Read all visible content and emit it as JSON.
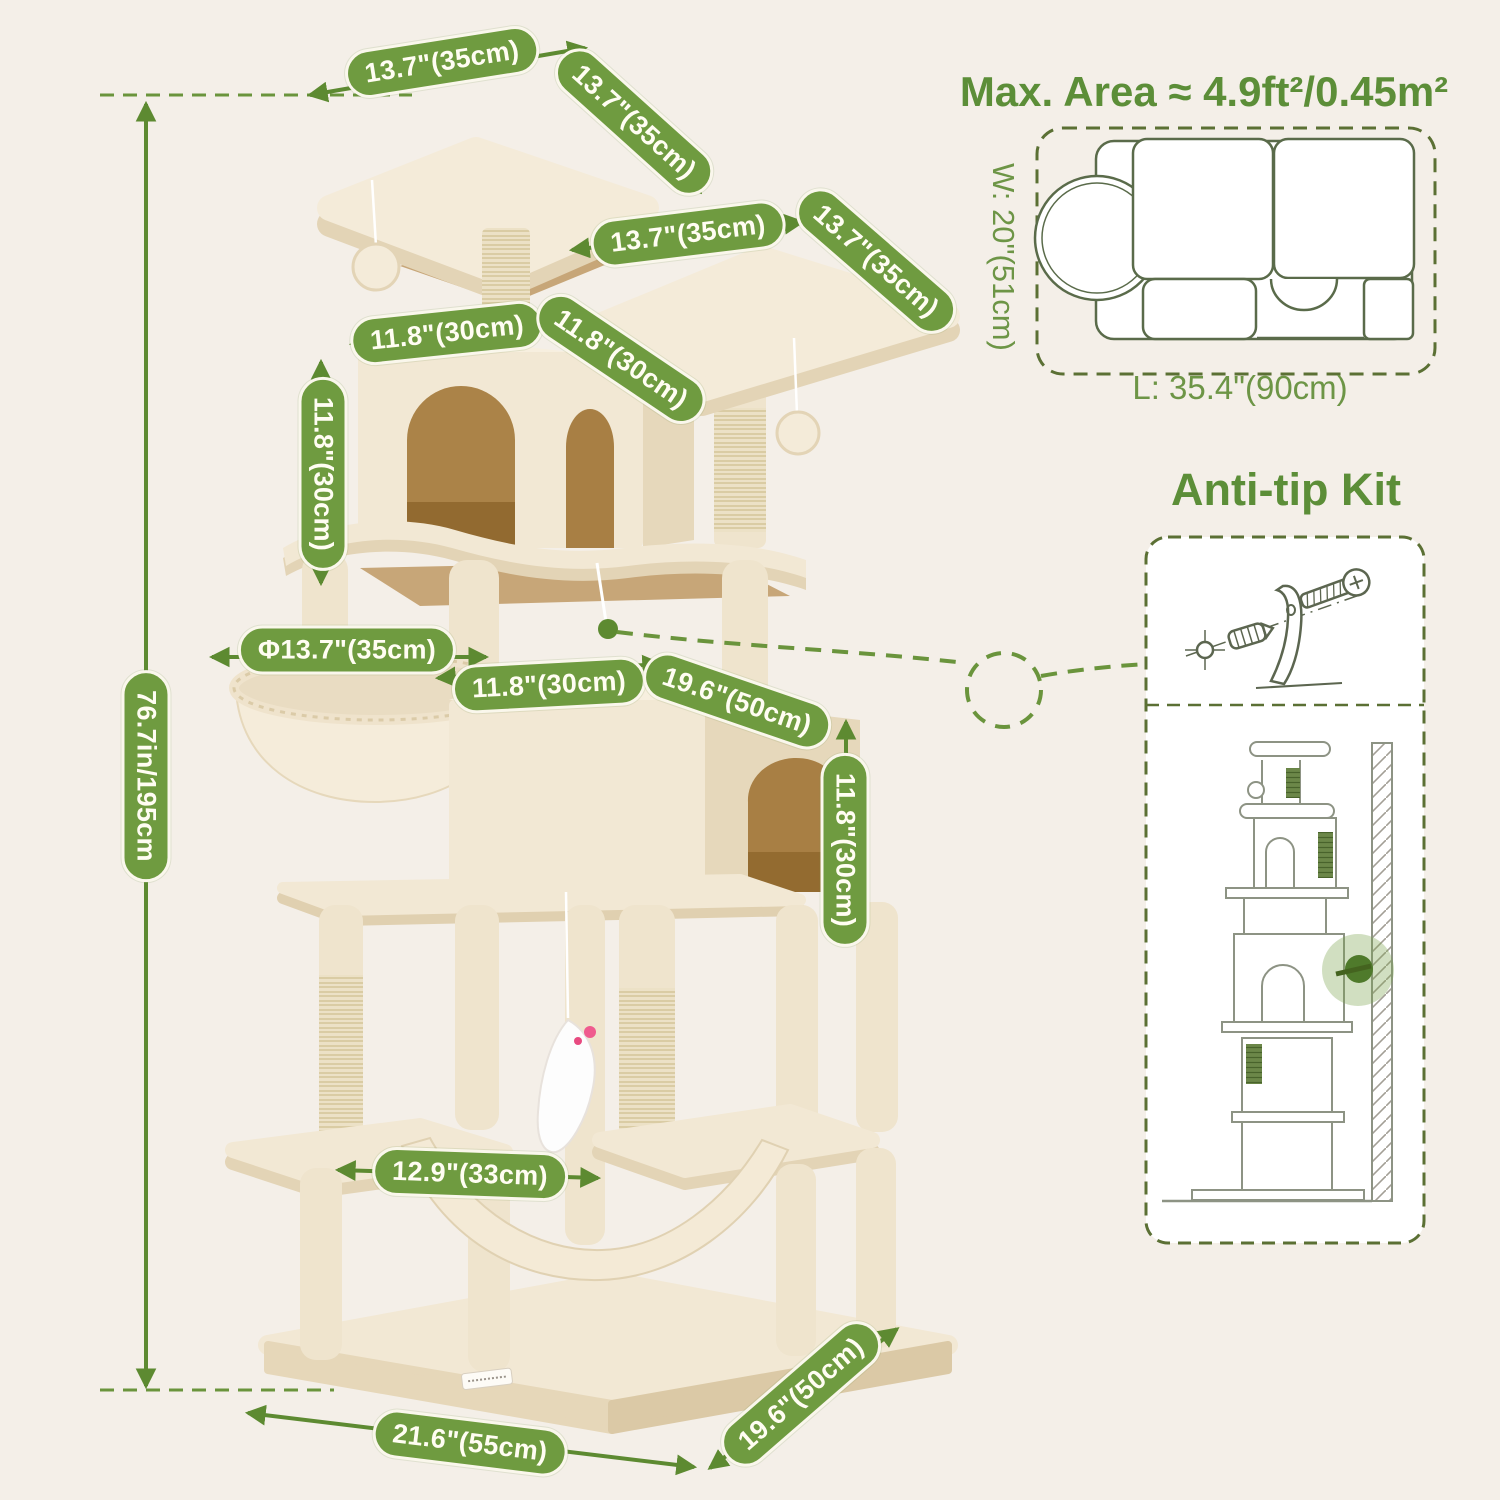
{
  "colors": {
    "background": "#f4efe8",
    "accent_green": "#5d8a31",
    "pill_green": "#6f9b40",
    "outline_olive": "#5b7034"
  },
  "dims": {
    "h_total": "76.7in/195cm",
    "top1_w": "13.7\"(35cm)",
    "top1_d": "13.7\"(35cm)",
    "top2_w": "13.7\"(35cm)",
    "top2_d": "13.7\"(35cm)",
    "condo_w": "11.8\"(30cm)",
    "condo_d": "11.8\"(30cm)",
    "condo_h": "11.8\"(30cm)",
    "basket_dia": "Φ13.7\"(35cm)",
    "cube_w": "11.8\"(30cm)",
    "cube_d": "19.6\"(50cm)",
    "cube_h": "11.8\"(30cm)",
    "hammock_w": "12.9\"(33cm)",
    "base_w": "21.6\"(55cm)",
    "base_d": "19.6\"(50cm)"
  },
  "right_panel": {
    "max_area_title": "Max. Area ≈ 4.9ft²/0.45m²",
    "width_label": "W: 20\"(51cm)",
    "length_label": "L: 35.4\"(90cm)",
    "anti_tip_title": "Anti-tip Kit"
  }
}
